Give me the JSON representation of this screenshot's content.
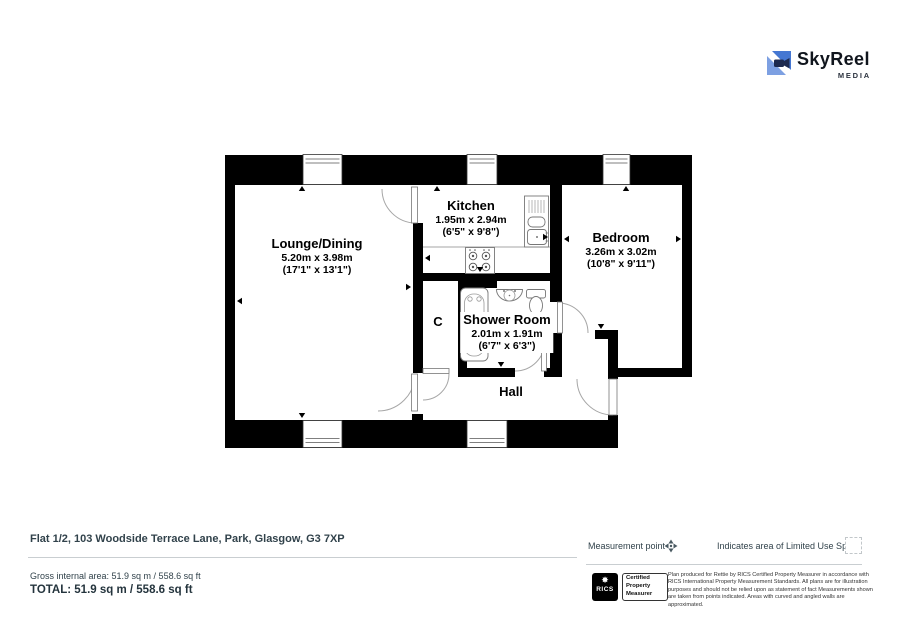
{
  "logo": {
    "brand": "SkyReel",
    "sub": "MEDIA"
  },
  "plan": {
    "rooms": [
      {
        "id": "lounge",
        "name": "Lounge/Dining",
        "metric": "5.20m x 3.98m",
        "imperial": "(17'1\" x 13'1\")"
      },
      {
        "id": "kitchen",
        "name": "Kitchen",
        "metric": "1.95m x 2.94m",
        "imperial": "(6'5\" x 9'8\")"
      },
      {
        "id": "bedroom",
        "name": "Bedroom",
        "metric": "3.26m x 3.02m",
        "imperial": "(10'8\" x 9'11\")"
      },
      {
        "id": "shower",
        "name": "Shower Room",
        "metric": "2.01m x 1.91m",
        "imperial": "(6'7\" x 6'3\")"
      },
      {
        "id": "cupboard",
        "name": "C"
      },
      {
        "id": "hall",
        "name": "Hall"
      }
    ]
  },
  "legend": {
    "measurement_point": "Measurement point",
    "limited_use": "Indicates area of  Limited Use Space"
  },
  "footer": {
    "address": "Flat 1/2, 103 Woodside Terrace Lane, Park, Glasgow, G3 7XP",
    "gross_area": "Gross internal area: 51.9 sq m / 558.6 sq ft",
    "total_area": "TOTAL: 51.9 sq m / 558.6 sq ft"
  },
  "rics": {
    "badge": "RICS",
    "certified": "Certified Property Measurer",
    "disclaimer": "Plan produced for Rettie by RICS Certified Property Measurer in accordance with RICS International Property Measurement Standards. All plans are for illustration purposes and should not be relied upon as statement of fact Measurements shown are taken from points indicated. Areas with curved and angled walls are approximated."
  }
}
